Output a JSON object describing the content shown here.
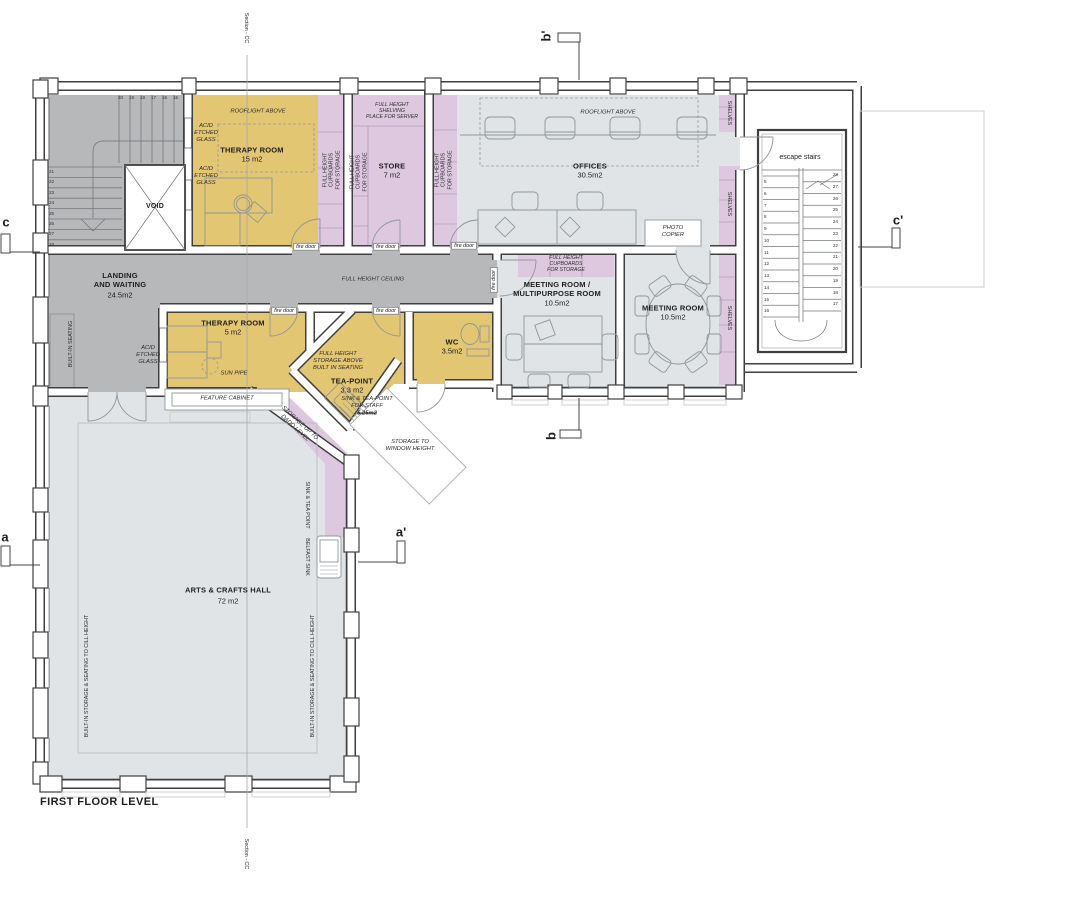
{
  "title": "FIRST FLOOR LEVEL",
  "colors": {
    "wall": "#3f3f3f",
    "landing": "#b6b8ba",
    "room": "#e0e4e6",
    "therapy": "#e2c672",
    "storage": "#ddc8e0",
    "outline": "#cccccc",
    "furn": "#8f969a"
  },
  "section_markers": {
    "cc": "Section - CC",
    "a": "a",
    "a_prime": "a'",
    "b": "b",
    "b_prime": "b'",
    "c": "c",
    "c_prime": "c'"
  },
  "rooms": {
    "therapy_room_large": {
      "name": "THERAPY ROOM",
      "area": "15 m2"
    },
    "therapy_room_small": {
      "name": "THERAPY ROOM",
      "area": "5 m2"
    },
    "store": {
      "name": "STORE",
      "area": "7 m2"
    },
    "offices": {
      "name": "OFFICES",
      "area": "30.5m2"
    },
    "landing": {
      "name": "LANDING\nAND WAITING",
      "area": "24.5m2"
    },
    "meeting_multipurpose": {
      "name": "MEETING ROOM /\nMULTIPURPOSE ROOM",
      "area": "10.5m2"
    },
    "meeting_room": {
      "name": "MEETING ROOM",
      "area": "10.5m2"
    },
    "tea_point": {
      "name": "TEA-POINT",
      "area": "3.3 m2"
    },
    "wc": {
      "name": "WC",
      "area": "3.5m2"
    },
    "arts_crafts_hall": {
      "name": "ARTS & CRAFTS HALL",
      "area": "72 m2"
    },
    "void": "VOID",
    "escape_stairs": "escape stairs"
  },
  "annotations": {
    "rooflight_above": "ROOFLIGHT ABOVE",
    "acid_etched_glass": "ACID\nETCHED\nGLASS",
    "fire_door": "fire door",
    "full_height_ceiling": "FULL HEIGHT CEILING",
    "full_height_cupboards": "FULL HEIGHT\nCUPBOARDS\nFOR STORAGE",
    "full_height_shelving_server": "FULL HEIGHT\nSHELVING\nPLACE FOR SERVER",
    "shelves": "SHELVES",
    "photo_copier": "PHOTO\nCOPIER",
    "sun_pipe": "SUN PIPE",
    "feature_cabinet": "FEATURE CABINET",
    "built_in_seating": "BUILT-IN SEATING",
    "built_in_storage_seating": "BUILT-IN STORAGE & SEATING TO CILL HEIGHT",
    "full_height_storage_above": "FULL HEIGHT\nSTORAGE ABOVE\nBUILT IN SEATING",
    "sink_tea_point_staff": "SINK & TEA-POINT\nFOR STAFF",
    "sink_tea_point_staff_area": "5.25m2",
    "storage_window_height": "STORAGE TO\nWINDOW HEIGHT",
    "storage_dado": "STORAGE UP TO\nDADO LEVEL",
    "sink_tea_point": "SINK & TEA POINT",
    "belfast_sink": "BELFAST SINK"
  },
  "stairs": {
    "main_top_numbers": [
      "20",
      "19",
      "18",
      "17",
      "16",
      "15"
    ],
    "main_side_numbers": [
      "21",
      "22",
      "23",
      "24",
      "25",
      "26",
      "27",
      "28"
    ],
    "escape_left_numbers": [
      "5",
      "6",
      "7",
      "8",
      "9",
      "10",
      "11",
      "12",
      "13",
      "14",
      "15",
      "16"
    ],
    "escape_right_numbers": [
      "28",
      "27",
      "26",
      "25",
      "24",
      "23",
      "22",
      "21",
      "20",
      "19",
      "18",
      "17"
    ]
  }
}
